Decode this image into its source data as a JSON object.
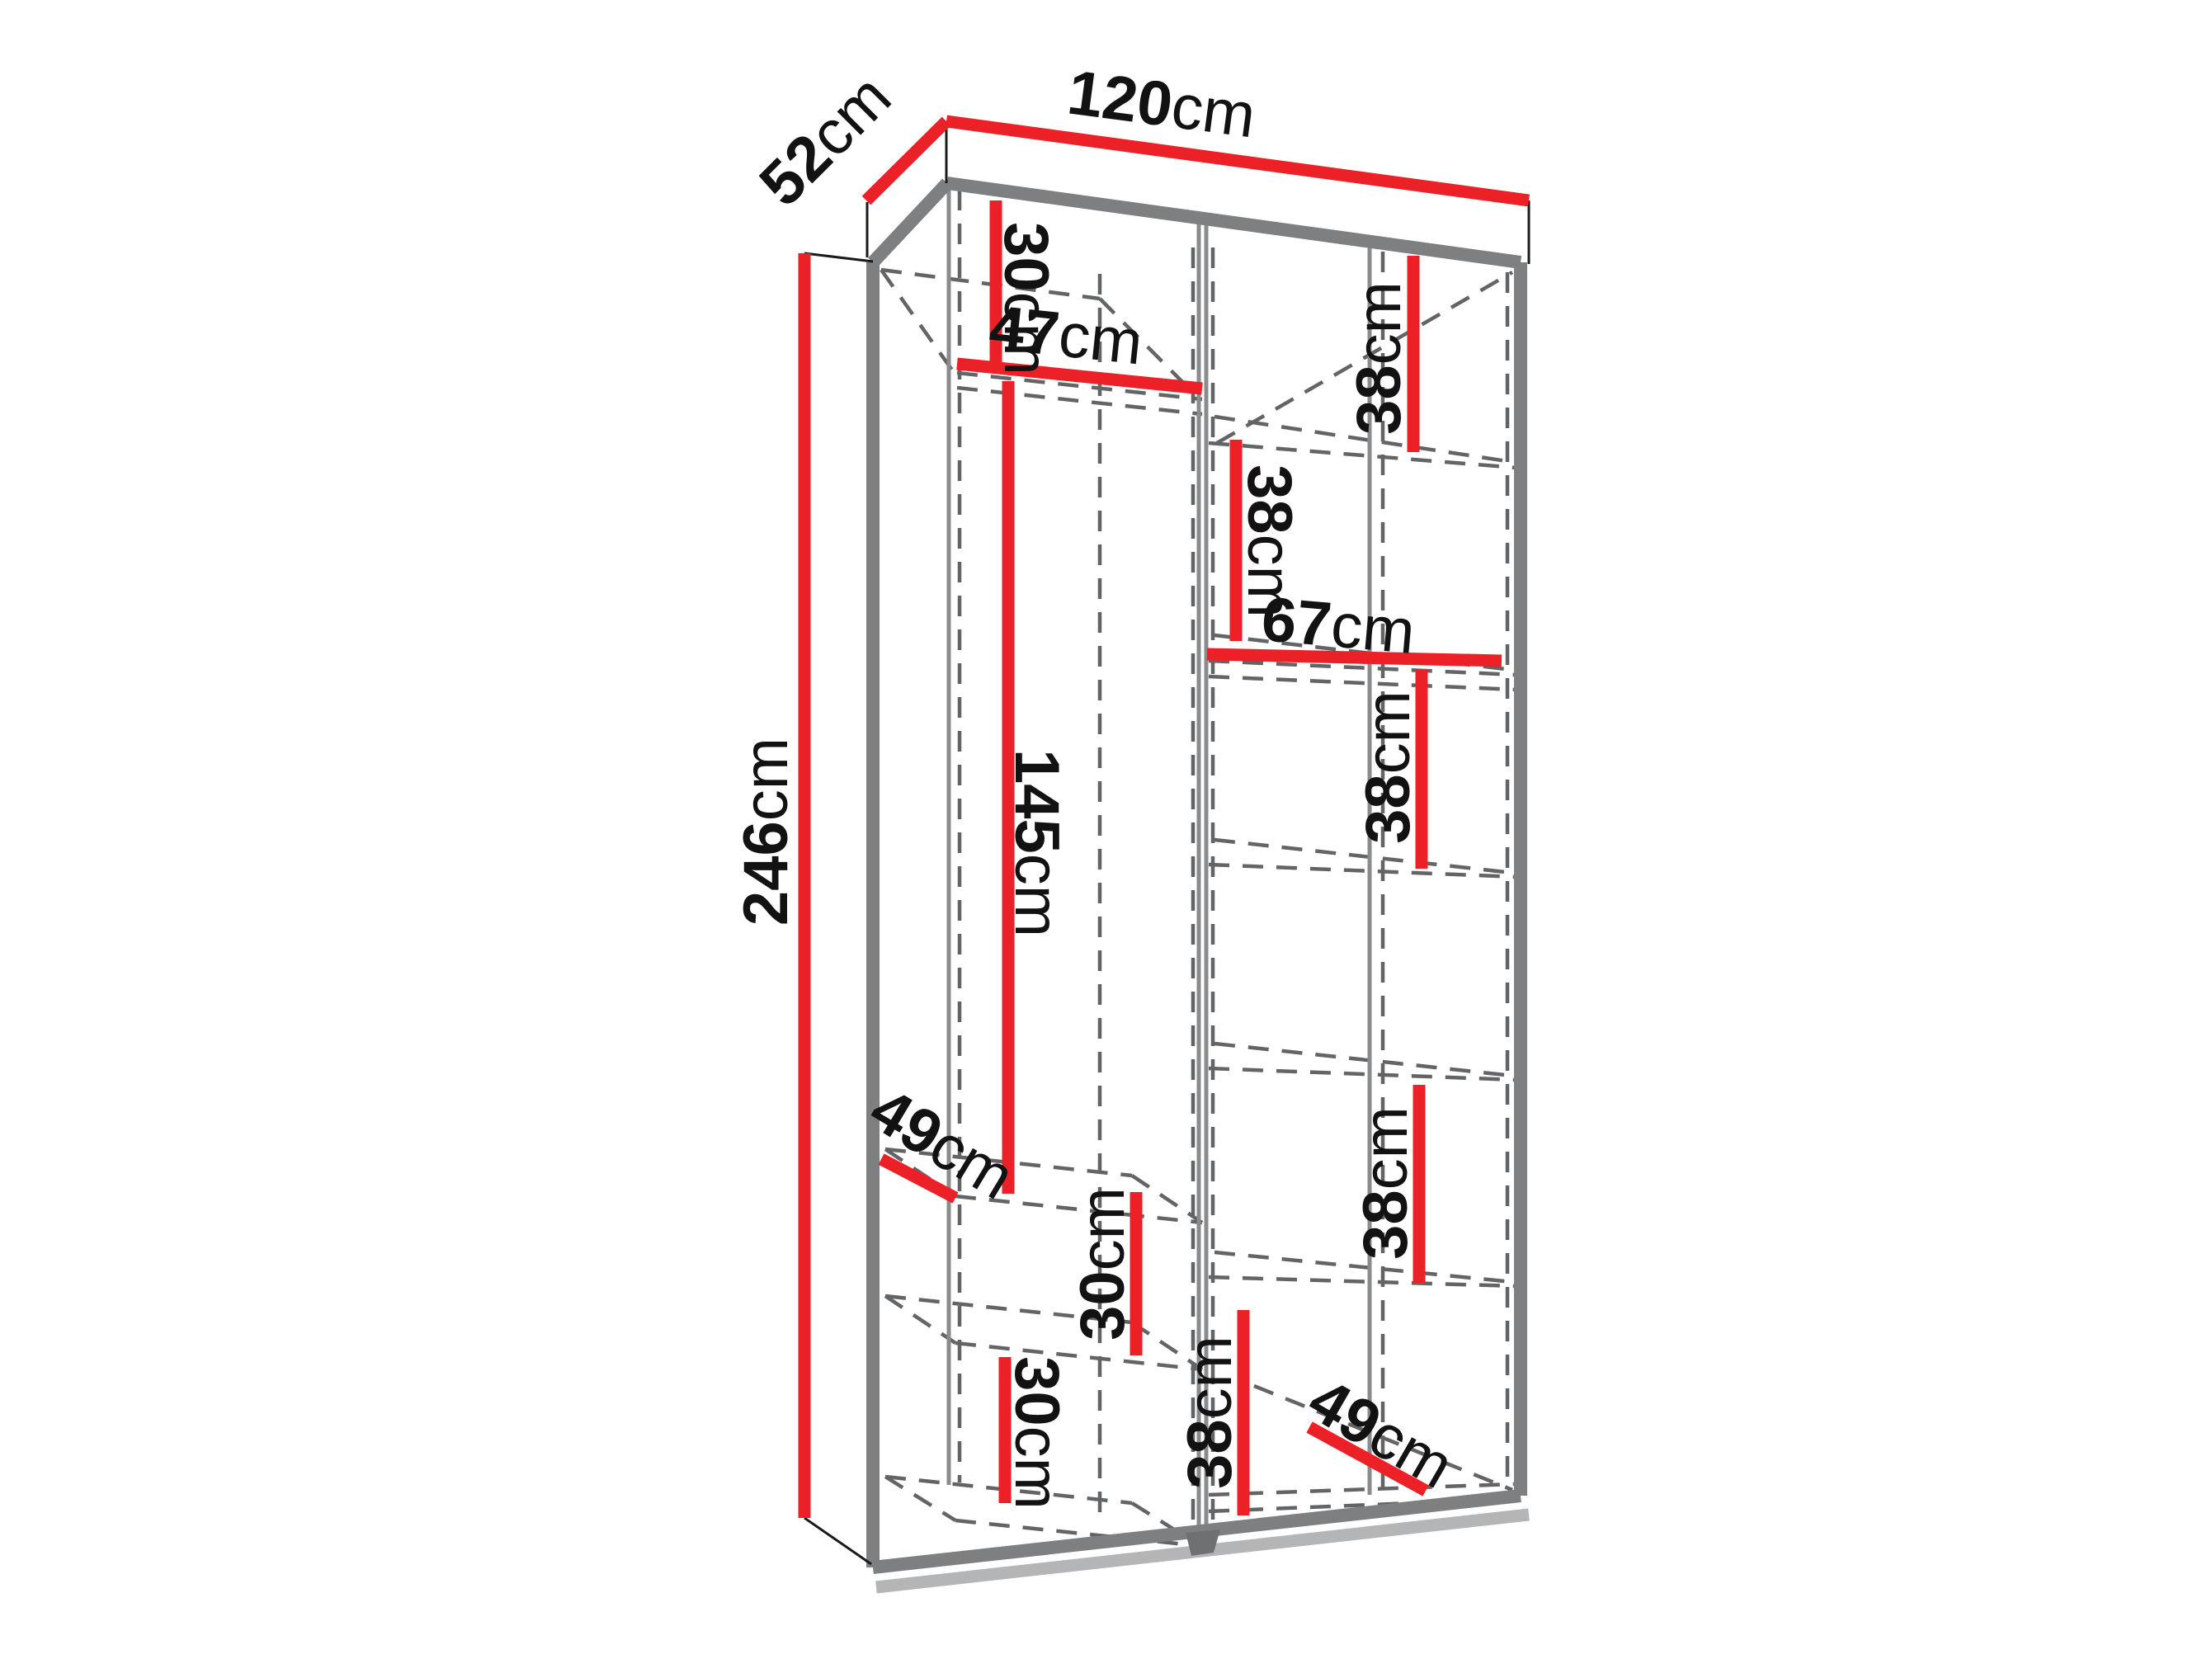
{
  "diagram": {
    "kind": "wardrobe-dimension-drawing",
    "description": "3D line drawing of a two-section wardrobe interior with red dimension lines",
    "unit": "cm"
  },
  "colors": {
    "background": "#ffffff",
    "dimension_line_red": "#ec2127",
    "cabinet_edge_gray": "#7e7f81",
    "hidden_edge_dashed_gray": "#636466",
    "label_text": "#121212"
  },
  "labels": [
    {
      "id": "width-top",
      "value": "120",
      "unit": "cm"
    },
    {
      "id": "depth-top",
      "value": "52",
      "unit": "cm"
    },
    {
      "id": "height-left",
      "value": "246",
      "unit": "cm"
    },
    {
      "id": "left-top-gap",
      "value": "30",
      "unit": "cm"
    },
    {
      "id": "left-shelf-width",
      "value": "47",
      "unit": "cm"
    },
    {
      "id": "hanging-height",
      "value": "145",
      "unit": "cm"
    },
    {
      "id": "right-gap-1",
      "value": "38",
      "unit": "cm"
    },
    {
      "id": "right-gap-2",
      "value": "38",
      "unit": "cm"
    },
    {
      "id": "right-shelf-width",
      "value": "67",
      "unit": "cm"
    },
    {
      "id": "right-gap-3",
      "value": "38",
      "unit": "cm"
    },
    {
      "id": "right-gap-4",
      "value": "38",
      "unit": "cm"
    },
    {
      "id": "right-gap-5",
      "value": "38",
      "unit": "cm"
    },
    {
      "id": "left-gap-mid",
      "value": "30",
      "unit": "cm"
    },
    {
      "id": "left-gap-bottom",
      "value": "30",
      "unit": "cm"
    },
    {
      "id": "left-shelf-depth",
      "value": "49",
      "unit": "cm"
    },
    {
      "id": "right-shelf-depth",
      "value": "49",
      "unit": "cm"
    }
  ]
}
